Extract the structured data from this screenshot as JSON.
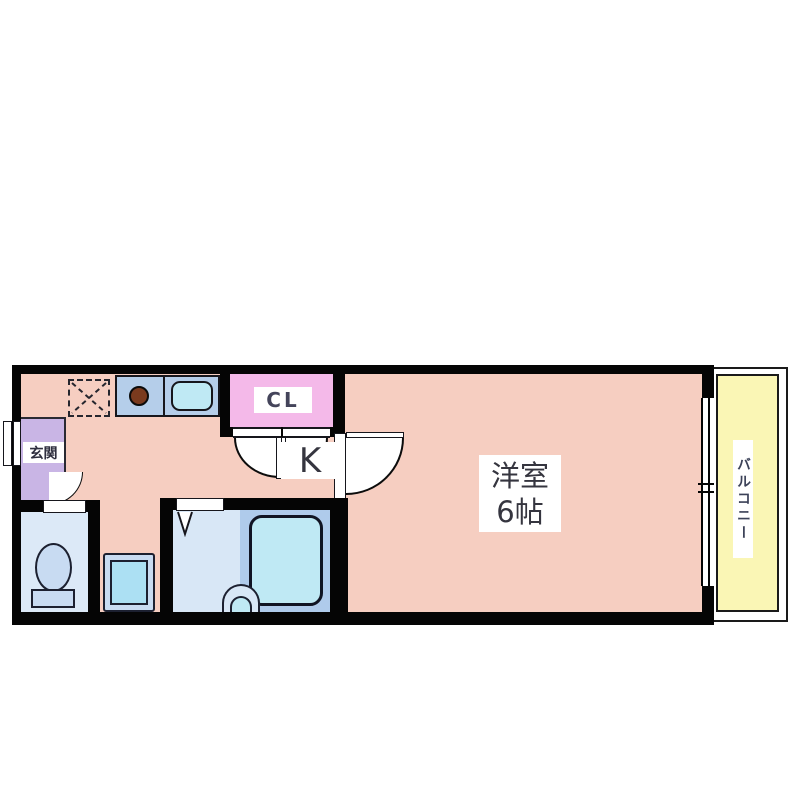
{
  "floorplan": {
    "labels": {
      "kitchen": "K",
      "closet": "CL",
      "entrance": "玄関",
      "main_room_line1": "洋室",
      "main_room_line2": "6帖",
      "balcony": "バルコニー"
    },
    "colors": {
      "floor_salmon": "#F6CEC1",
      "wall": "#050505",
      "closet_pink": "#F4B9E9",
      "entrance_purple": "#C9B5E5",
      "counter_blue": "#B5CEEA",
      "fixture_cyan": "#BFE9F4",
      "bath_floor": "#D8E7F6",
      "toilet_floor": "#DCE9F7",
      "tub_panel": "#AFCBEB",
      "balcony_yellow": "#FAF6B5",
      "burner_brown": "#7A3A1E",
      "label_text": "#35353f"
    }
  }
}
